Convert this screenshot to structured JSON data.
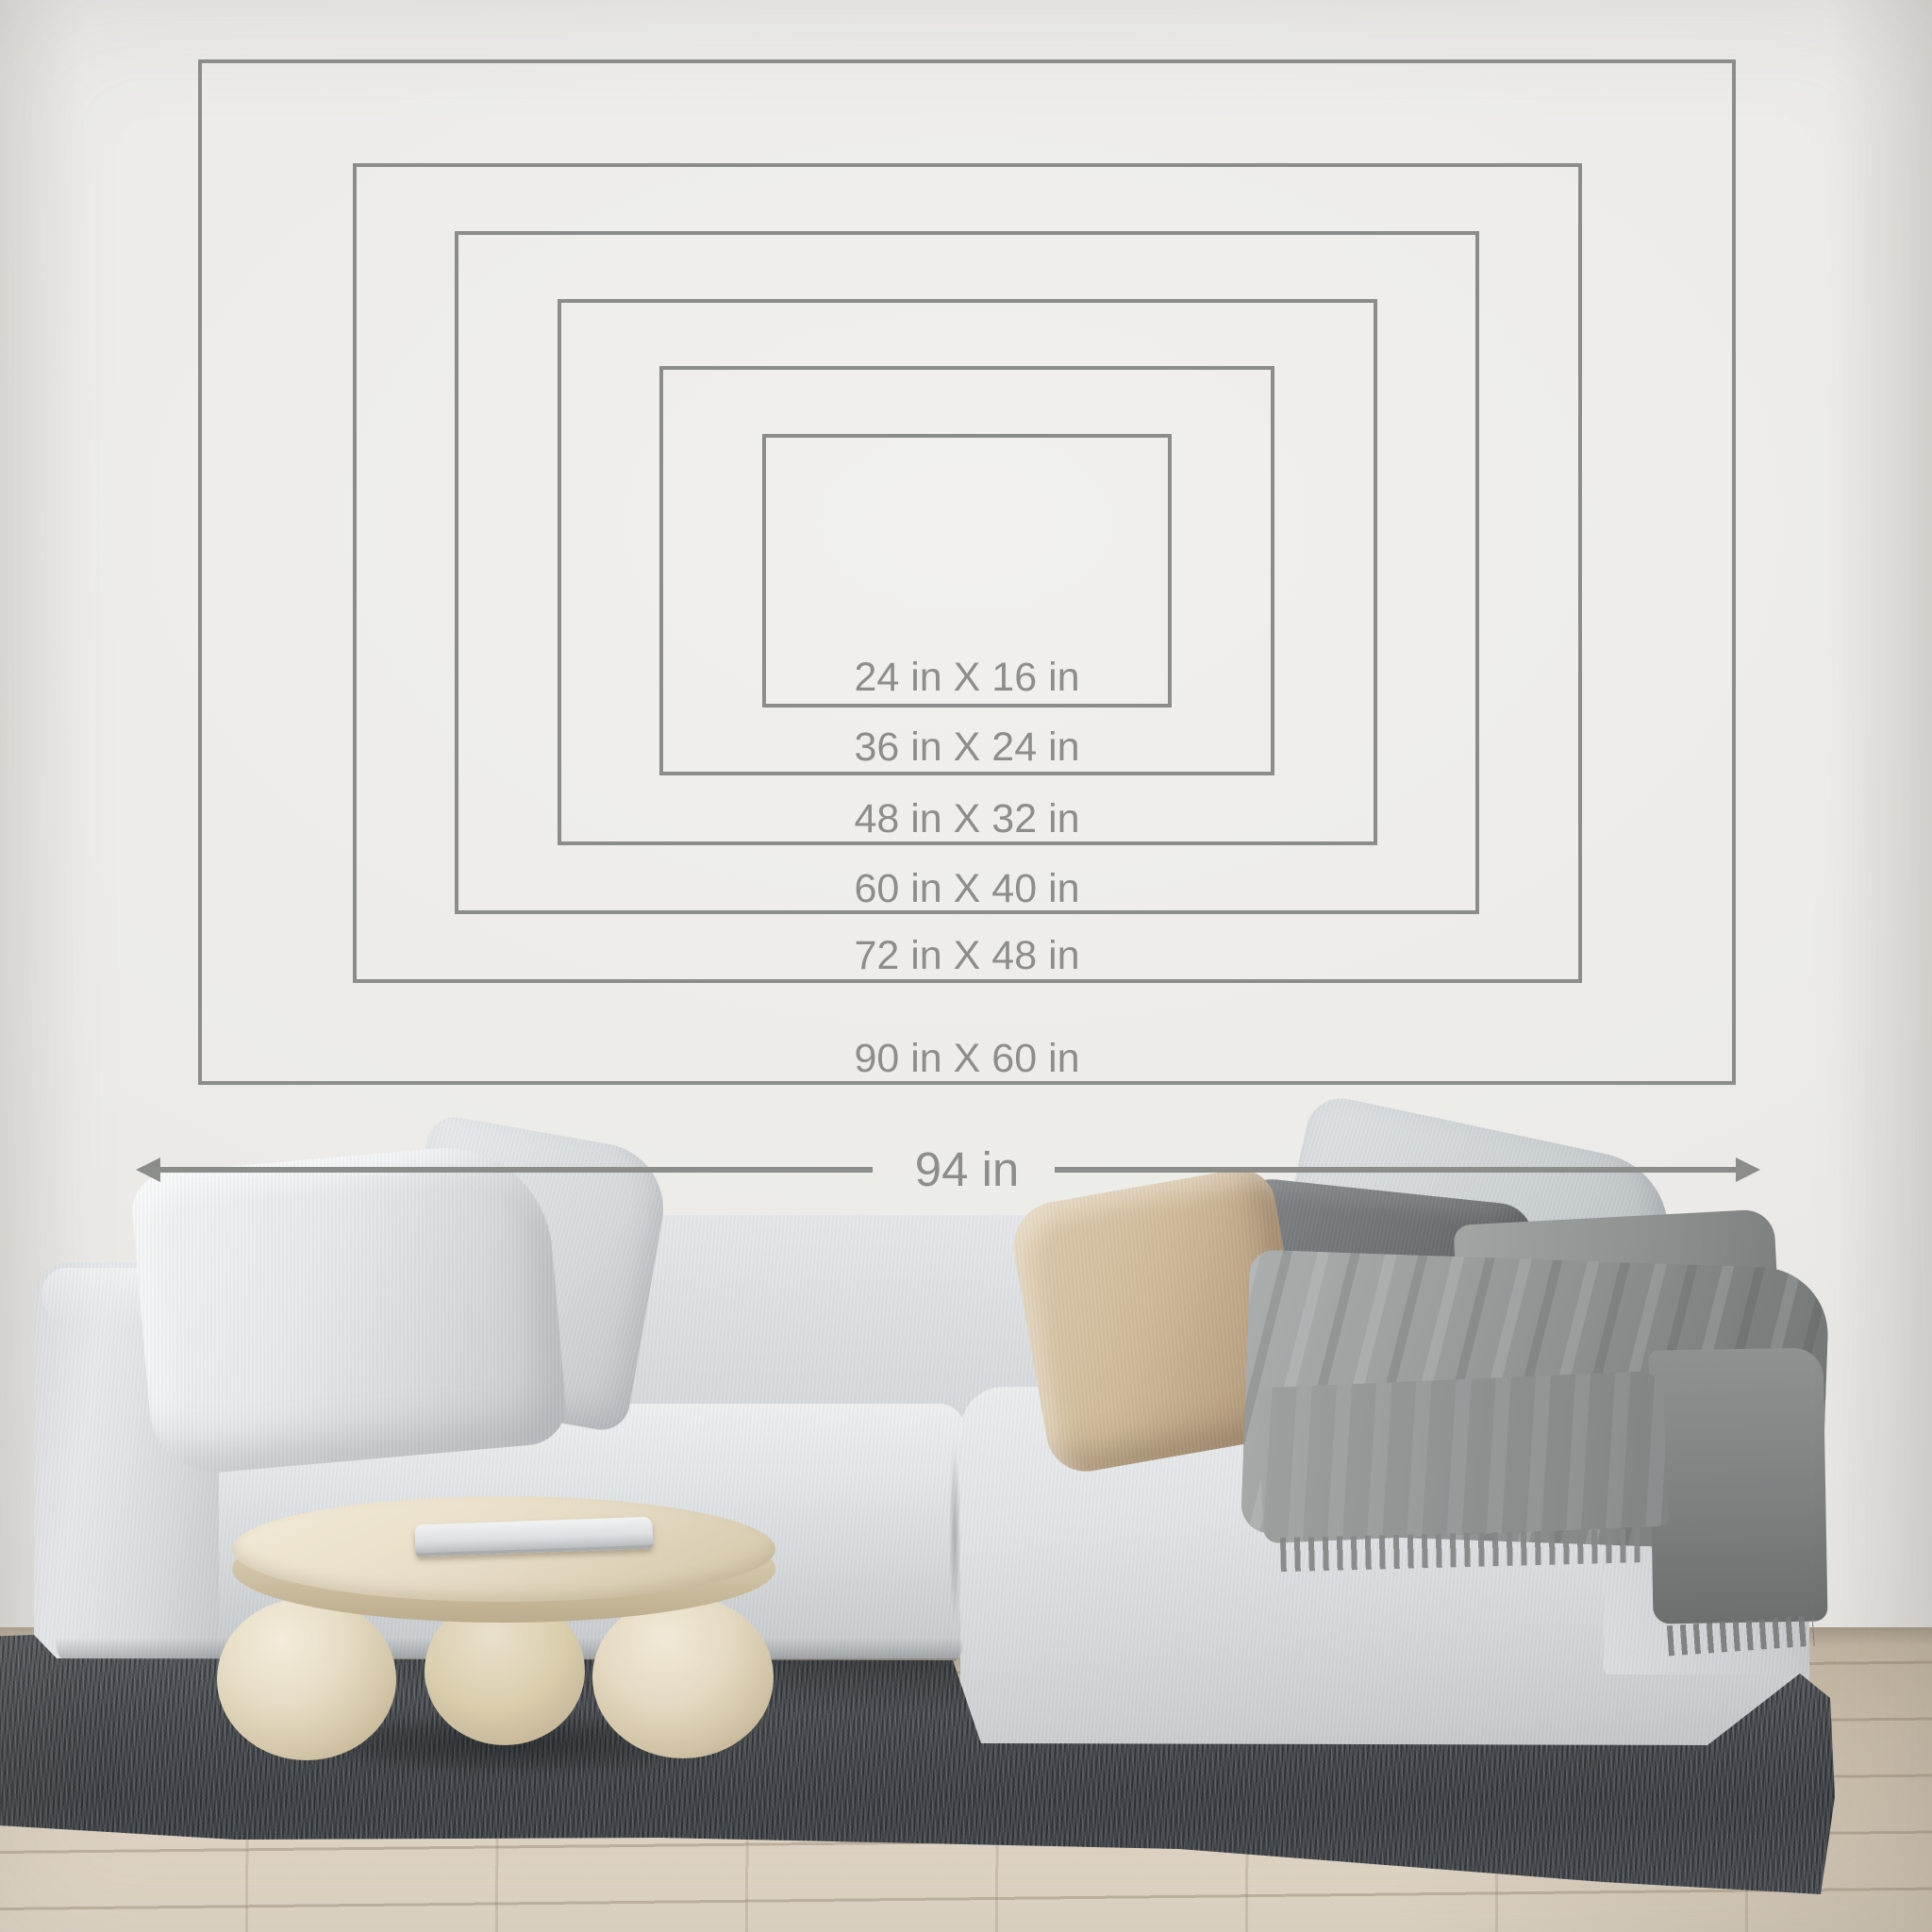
{
  "overlay": {
    "line_color": "#8b8d8a",
    "text_color": "#8d8e8c",
    "unit": "in",
    "sizes": [
      {
        "id": "90x60",
        "label": "90 in X 60 in",
        "width_in": 90,
        "height_in": 60
      },
      {
        "id": "72x48",
        "label": "72 in X 48 in",
        "width_in": 72,
        "height_in": 48
      },
      {
        "id": "60x40",
        "label": "60 in X 40 in",
        "width_in": 60,
        "height_in": 40
      },
      {
        "id": "48x32",
        "label": "48 in X 32 in",
        "width_in": 48,
        "height_in": 32
      },
      {
        "id": "36x24",
        "label": "36 in X 24 in",
        "width_in": 36,
        "height_in": 24
      },
      {
        "id": "24x16",
        "label": "24 in X 16 in",
        "width_in": 24,
        "height_in": 16
      }
    ],
    "reference_width": {
      "label": "94 in",
      "value_in": 94
    }
  },
  "scene": {
    "wall_color": "#ebeae7",
    "floor_color": "#d7cbb9",
    "rug_color": "#45494d",
    "sofa_color": "#d8dcdf",
    "pillow_colors": {
      "white_left": "#e7e9eb",
      "beige": "#cfb897",
      "dark_gray": "#6b6f72",
      "light_gray_right": "#ccd1d4"
    },
    "blanket_color": "#8b8f8e",
    "table_color": "#eae0ca",
    "laptop_color": "#e6e8e9"
  }
}
